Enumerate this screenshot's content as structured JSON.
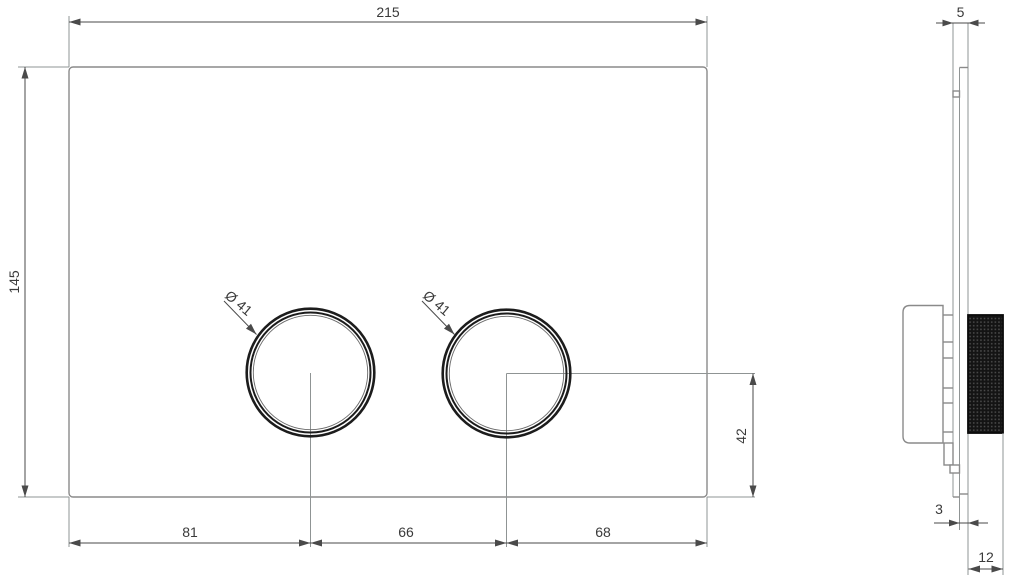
{
  "drawing_type": "flush-plate-technical-drawing",
  "front_view": {
    "width_label": "215",
    "height_label": "145",
    "left_button_diameter_label": "Ø 41",
    "right_button_diameter_label": "Ø 41",
    "bottom_left_spacing_label": "81",
    "bottom_center_spacing_label": "66",
    "bottom_right_spacing_label": "68",
    "button_center_to_bottom_label": "42"
  },
  "side_view": {
    "total_depth_label": "5",
    "front_offset_label": "3",
    "button_projection_label": "12"
  },
  "colors": {
    "background": "#ffffff",
    "object_line": "#8a8a8a",
    "dimension_line": "#4a4a4a",
    "button_ring": "#1c1c1c",
    "knurl_dark": "#141414",
    "text": "#3a3a3a"
  }
}
